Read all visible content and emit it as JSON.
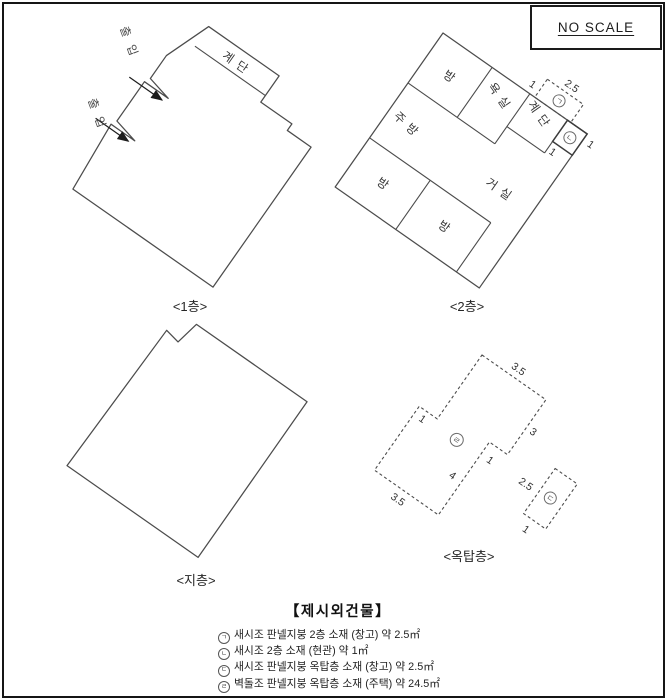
{
  "frame": {
    "no_scale": "NO SCALE"
  },
  "floor1": {
    "caption": "<1층>",
    "stairs_label": "계단",
    "entrance1": "출입",
    "entrance2": "출입"
  },
  "floor2": {
    "caption": "<2층>",
    "rooms": {
      "room_top": "방",
      "bath": "욕실",
      "kitchen": "주방",
      "room_left": "방",
      "room_bottom": "방",
      "living": "거실",
      "stairs": "계단"
    },
    "annex": {
      "marker_a": "ㄱ",
      "marker_b": "ㄴ",
      "dim_width": "2.5",
      "dim_left": "1",
      "dim_below": "1",
      "dim_right": "1"
    }
  },
  "basement": {
    "caption": "<지층>"
  },
  "rooftop": {
    "caption": "<옥탑층>",
    "main": {
      "marker": "ㄹ",
      "dim_top": "3.5",
      "dim_right": "3",
      "dim_step": "1",
      "dim_lower_right": "4",
      "dim_bottom": "3.5",
      "dim_left_step": "1"
    },
    "shed": {
      "marker": "ㄷ",
      "dim_long": "2.5",
      "dim_short": "1"
    }
  },
  "legend": {
    "title": "【제시외건물】",
    "items": [
      {
        "marker": "ㄱ",
        "text": "새시조 판넬지붕 2층 소재 (창고) 약 2.5㎡"
      },
      {
        "marker": "ㄴ",
        "text": "새시조 2층 소재 (현관) 약 1㎡"
      },
      {
        "marker": "ㄷ",
        "text": "새시조 판넬지붕 옥탑층 소재 (창고) 약 2.5㎡"
      },
      {
        "marker": "ㄹ",
        "text": "벽돌조 판넬지붕 옥탑층 소재 (주택) 약 24.5㎡"
      }
    ]
  }
}
